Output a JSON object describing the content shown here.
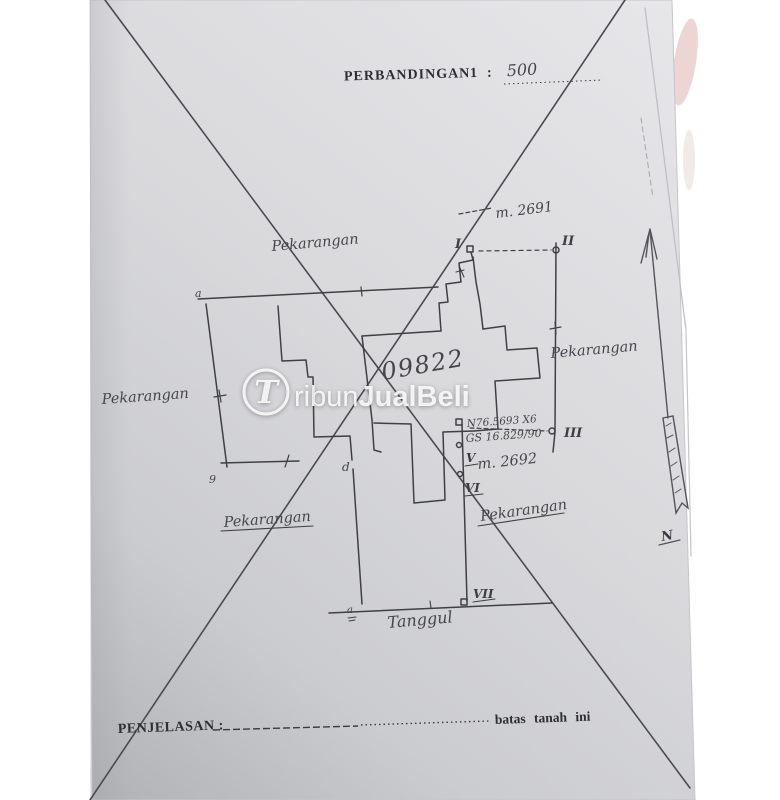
{
  "header": {
    "label": "PERBANDINGAN",
    "number": "1",
    "colon": ":",
    "value": "500"
  },
  "watermark": {
    "initial": "T",
    "name_light": "ribun",
    "name_bold": "JualBeli"
  },
  "map": {
    "plot_number": "09822",
    "area_labels": {
      "top": "Pekarangan",
      "left": "Pekarangan",
      "right": "Pekarangan",
      "bottom_left": "Pekarangan",
      "bottom_right": "Pekarangan"
    },
    "road_label": "Tanggul",
    "measure_top": "m. 2691",
    "measure_mid": "m. 2692",
    "ref_line1": "N76.5693 X6",
    "ref_line2": "GS 16.829/90",
    "points": {
      "i": "I",
      "ii": "II",
      "iii": "III",
      "v": "V",
      "vi": "VI",
      "vii": "VII"
    },
    "marks": {
      "corner_top": "a",
      "corner_bottom": "9",
      "corner_mid": "d",
      "road_mark": "a"
    },
    "north_label": "N"
  },
  "footer": {
    "label": "PENJELASAN :",
    "note": "batas tanah ini"
  },
  "colors": {
    "paper_light": "#e4e4e7",
    "paper_dark": "#b3b4b8",
    "ink": "#3f3f46",
    "watermark": "#fbfbfb"
  }
}
